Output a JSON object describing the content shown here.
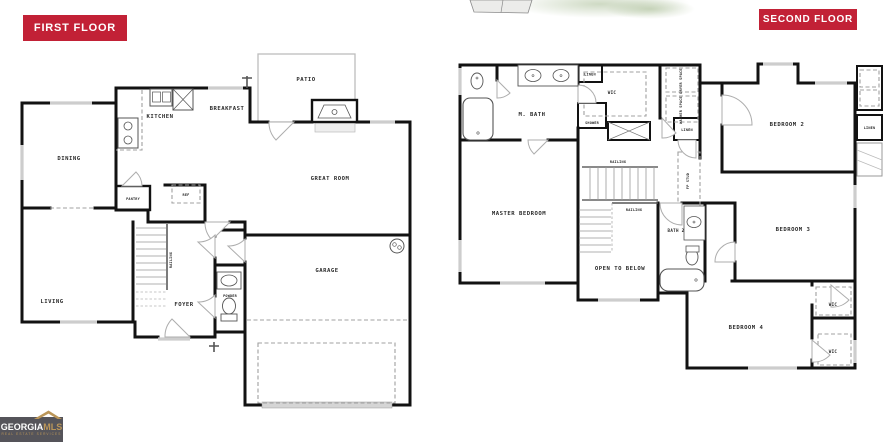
{
  "badges": {
    "first": "FIRST FLOOR",
    "second": "SECOND FLOOR",
    "bg_color": "#c22136",
    "text_color": "#ffffff"
  },
  "logo": {
    "brand_left": "GEORGIA",
    "brand_right": "MLS",
    "tagline": "REAL ESTATE SERVICES",
    "bg_color": "#55545a",
    "gold_color": "#bb9659",
    "roof_icon": "house-roof-icon"
  },
  "first_floor": {
    "labels": {
      "dining": "DINING",
      "kitchen": "KITCHEN",
      "breakfast": "BREAKFAST",
      "patio": "PATIO",
      "great_room": "GREAT ROOM",
      "pantry": "PANTRY",
      "ref": "REF",
      "railing": "RAILING",
      "living": "LIVING",
      "foyer": "FOYER",
      "powder": "POWDER",
      "garage": "GARAGE"
    }
  },
  "second_floor": {
    "labels": {
      "m_bath": "M. BATH",
      "wic": "WIC",
      "linen_top": "LINEN",
      "shower": "SHOWER",
      "dryer": "DRYER SPACE",
      "washer": "WASHER SPACE",
      "linen_hall": "LINEN",
      "bedroom2": "BEDROOM 2",
      "master": "MASTER BEDROOM",
      "railing_top": "RAILING",
      "railing_open": "RAILING",
      "fp_stud": "FP STUD",
      "open_below": "OPEN TO BELOW",
      "bath2": "BATH 2",
      "bedroom3": "BEDROOM 3",
      "bedroom4": "BEDROOM 4",
      "wic_b4_top": "WIC",
      "wic_b4_bottom": "WIC",
      "linen_right": "LINEN"
    }
  },
  "colors": {
    "wall": "#121212",
    "window": "#cdcdcd",
    "door_swing": "#adadad",
    "dashed": "#a0a0a0",
    "stairs": "#999999",
    "fixture": "#555555"
  }
}
